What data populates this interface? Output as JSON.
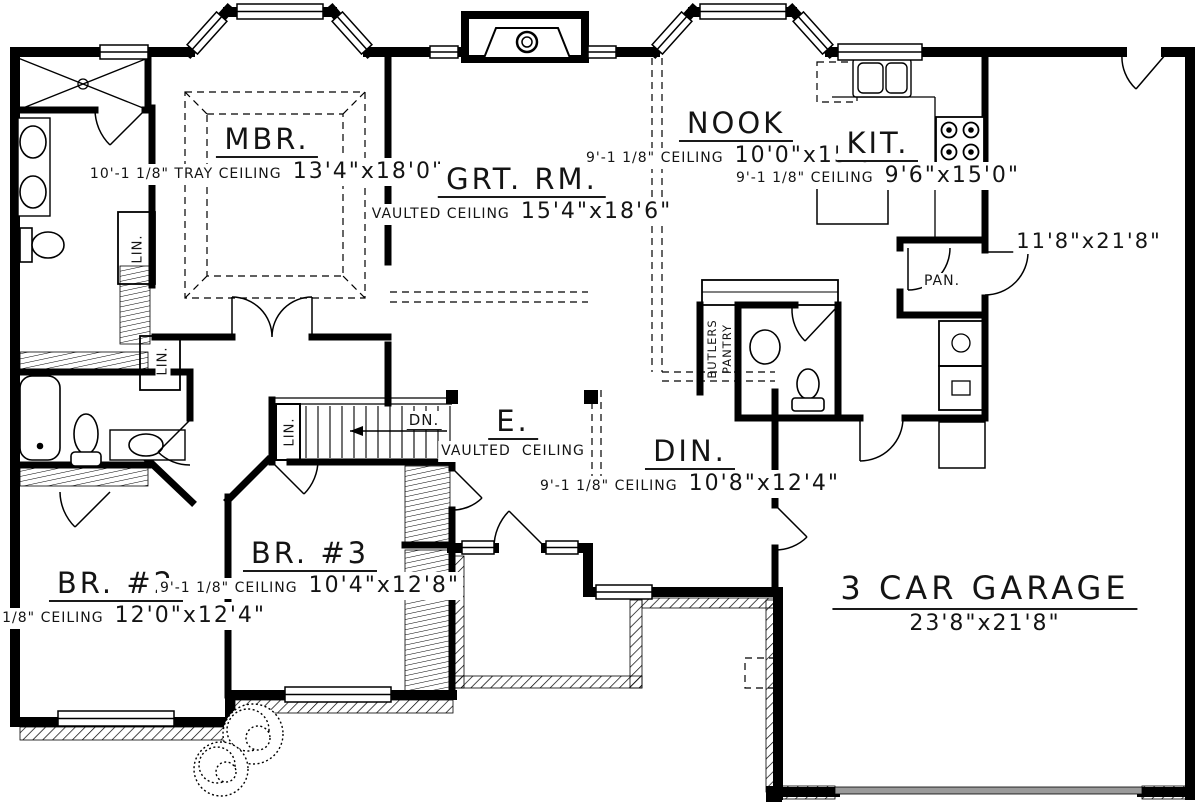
{
  "rooms": {
    "mbr": {
      "name": "MBR.",
      "ceiling": "10'-1 1/8\" TRAY CEILING",
      "size": "13'4\"x18'0\""
    },
    "grt": {
      "name": "GRT. RM.",
      "ceiling": "VAULTED CEILING",
      "size": "15'4\"x18'6\""
    },
    "nook": {
      "name": "NOOK",
      "ceiling": "9'-1 1/8\" CEILING",
      "size": "10'0\"x15'0\""
    },
    "kit": {
      "name": "KIT.",
      "ceiling": "9'-1 1/8\" CEILING",
      "size": "9'6\"x15'0\""
    },
    "din": {
      "name": "DIN.",
      "ceiling": "9'-1 1/8\" CEILING",
      "size": "10'8\"x12'4\""
    },
    "entry": {
      "name": "E.",
      "ceiling_line1": "VAULTED",
      "ceiling_line2": "CEILING"
    },
    "br2": {
      "name": "BR. #2",
      "ceiling": "9'-1 1/8\" CEILING",
      "size": "12'0\"x12'4\""
    },
    "br3": {
      "name": "BR. #3",
      "ceiling": "9'-1 1/8\" CEILING",
      "size": "10'4\"x12'8\""
    },
    "garage": {
      "name": "3 CAR GARAGE",
      "size": "23'8\"x21'8\""
    },
    "bonus": {
      "size": "11'8\"x21'8\""
    }
  },
  "labels": {
    "pantry": "PAN.",
    "linen": "LIN.",
    "down": "DN.",
    "butlers_1": "BUTLERS",
    "butlers_2": "PANTRY"
  },
  "colors": {
    "wall": "#000000",
    "text": "#141414",
    "garage_door": "#9a9a9a"
  }
}
